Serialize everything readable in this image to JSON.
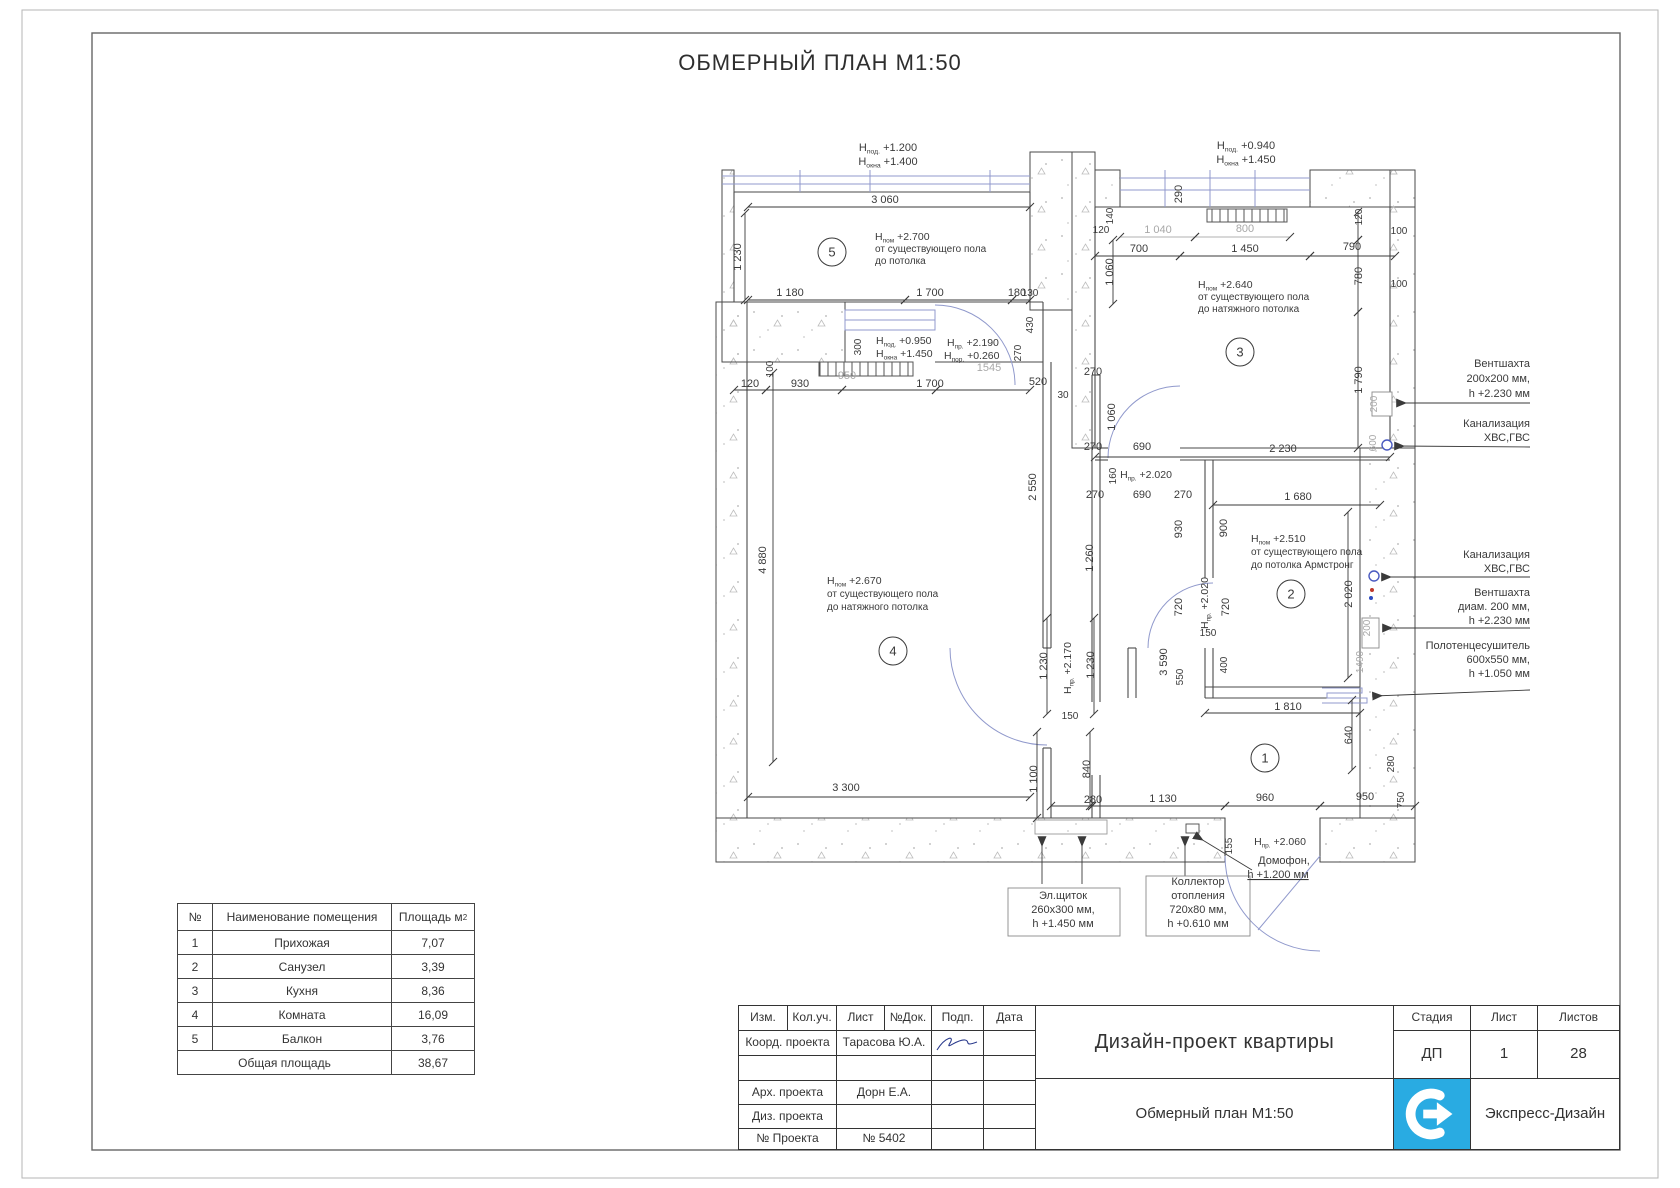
{
  "sheet": {
    "title": "ОБМЕРНЫЙ ПЛАН М1:50"
  },
  "colors": {
    "accent_blue": "#9099cc",
    "utility_blue": "#4a5ac0",
    "logo_blue": "#29abe2",
    "dim_gray": "#a8a8a8",
    "line": "#3a3a3a"
  },
  "plan": {
    "rooms": [
      {
        "n": "5",
        "x": 832,
        "y": 252
      },
      {
        "n": "3",
        "x": 1240,
        "y": 352
      },
      {
        "n": "2",
        "x": 1291,
        "y": 594
      },
      {
        "n": "4",
        "x": 893,
        "y": 651
      },
      {
        "n": "1",
        "x": 1265,
        "y": 758
      }
    ],
    "texts": [
      {
        "t": "Н|под.| +1.200",
        "x": 888,
        "y": 151
      },
      {
        "t": "Н|окна| +1.400",
        "x": 888,
        "y": 165
      },
      {
        "t": "3 060",
        "x": 885,
        "y": 203
      },
      {
        "t": "1 230",
        "x": 741,
        "y": 257,
        "r": -90
      },
      {
        "t": "Н|пом| +2.700",
        "x": 875,
        "y": 240,
        "a": "start",
        "fs": 10.5
      },
      {
        "t": "от существующего пола",
        "x": 875,
        "y": 252,
        "a": "start",
        "fs": 10
      },
      {
        "t": "до потолка",
        "x": 875,
        "y": 264,
        "a": "start",
        "fs": 10
      },
      {
        "t": "1 180",
        "x": 790,
        "y": 296
      },
      {
        "t": "1 700",
        "x": 930,
        "y": 296
      },
      {
        "t": "180",
        "x": 1017,
        "y": 296
      },
      {
        "t": "300",
        "x": 861,
        "y": 347,
        "r": -90,
        "fs": 10
      },
      {
        "t": "Н|под.| +0.950",
        "x": 876,
        "y": 344,
        "a": "start",
        "fs": 10.5
      },
      {
        "t": "Н|окна| +1.450",
        "x": 876,
        "y": 357,
        "a": "start",
        "fs": 10.5
      },
      {
        "t": "Н|пр.| +2.190",
        "x": 947,
        "y": 346,
        "a": "start",
        "fs": 10.5
      },
      {
        "t": "Н|пор.| +0.260",
        "x": 944,
        "y": 359,
        "a": "start",
        "fs": 10.5
      },
      {
        "t": "1545",
        "x": 989,
        "y": 371,
        "c": "g"
      },
      {
        "t": "100",
        "x": 773,
        "y": 369,
        "r": -90,
        "fs": 10
      },
      {
        "t": "120",
        "x": 750,
        "y": 387
      },
      {
        "t": "930",
        "x": 800,
        "y": 387
      },
      {
        "t": "950",
        "x": 847,
        "y": 379,
        "c": "g"
      },
      {
        "t": "1 700",
        "x": 930,
        "y": 387
      },
      {
        "t": "520",
        "x": 1038,
        "y": 385
      },
      {
        "t": "30",
        "x": 1063,
        "y": 398,
        "fs": 10
      },
      {
        "t": "4 880",
        "x": 766,
        "y": 560,
        "r": -90
      },
      {
        "t": "Н|пом| +2.670",
        "x": 827,
        "y": 584,
        "a": "start",
        "fs": 10.5
      },
      {
        "t": "от существующего пола",
        "x": 827,
        "y": 597,
        "a": "start",
        "fs": 10
      },
      {
        "t": "до натяжного потолка",
        "x": 827,
        "y": 610,
        "a": "start",
        "fs": 10
      },
      {
        "t": "2 550",
        "x": 1036,
        "y": 487,
        "r": -90
      },
      {
        "t": "1 260",
        "x": 1093,
        "y": 558,
        "r": -90
      },
      {
        "t": "1 230",
        "x": 1047,
        "y": 666,
        "r": -90
      },
      {
        "t": "Н|пр.| +2.170",
        "x": 1071,
        "y": 668,
        "r": -90,
        "fs": 10.5
      },
      {
        "t": "1 230",
        "x": 1094,
        "y": 665,
        "r": -90
      },
      {
        "t": "150",
        "x": 1070,
        "y": 719,
        "fs": 10
      },
      {
        "t": "3 300",
        "x": 846,
        "y": 791
      },
      {
        "t": "1 100",
        "x": 1037,
        "y": 779,
        "r": -90
      },
      {
        "t": "840",
        "x": 1090,
        "y": 769,
        "r": -90
      },
      {
        "t": "1 060",
        "x": 1113,
        "y": 272,
        "r": -90
      },
      {
        "t": "130",
        "x": 1030,
        "y": 296,
        "fs": 10
      },
      {
        "t": "430",
        "x": 1033,
        "y": 325,
        "r": -90,
        "fs": 10
      },
      {
        "t": "270",
        "x": 1021,
        "y": 353,
        "r": -90,
        "fs": 10
      },
      {
        "t": "270",
        "x": 1093,
        "y": 375
      },
      {
        "t": "1 060",
        "x": 1115,
        "y": 417,
        "r": -90
      },
      {
        "t": "270",
        "x": 1093,
        "y": 450
      },
      {
        "t": "690",
        "x": 1142,
        "y": 450
      },
      {
        "t": "Н|пр.| +2.020",
        "x": 1146,
        "y": 478,
        "fs": 10.5
      },
      {
        "t": "160",
        "x": 1116,
        "y": 476,
        "r": -90,
        "fs": 10
      },
      {
        "t": "270",
        "x": 1095,
        "y": 498
      },
      {
        "t": "690",
        "x": 1142,
        "y": 498
      },
      {
        "t": "270",
        "x": 1183,
        "y": 498
      },
      {
        "t": "930",
        "x": 1182,
        "y": 529,
        "r": -90
      },
      {
        "t": "900",
        "x": 1227,
        "y": 528,
        "r": -90
      },
      {
        "t": "Н|под.| +0.940",
        "x": 1246,
        "y": 149
      },
      {
        "t": "Н|окна| +1.450",
        "x": 1246,
        "y": 163
      },
      {
        "t": "290",
        "x": 1182,
        "y": 194,
        "r": -90
      },
      {
        "t": "140",
        "x": 1113,
        "y": 216,
        "r": -90,
        "fs": 10
      },
      {
        "t": "120",
        "x": 1101,
        "y": 233,
        "fs": 10
      },
      {
        "t": "1 040",
        "x": 1158,
        "y": 233,
        "c": "g"
      },
      {
        "t": "800",
        "x": 1245,
        "y": 232,
        "c": "g"
      },
      {
        "t": "700",
        "x": 1139,
        "y": 252
      },
      {
        "t": "1 450",
        "x": 1245,
        "y": 252
      },
      {
        "t": "790",
        "x": 1352,
        "y": 250
      },
      {
        "t": "120",
        "x": 1362,
        "y": 217,
        "r": -90,
        "fs": 10
      },
      {
        "t": "100",
        "x": 1399,
        "y": 234,
        "fs": 10
      },
      {
        "t": "780",
        "x": 1362,
        "y": 276,
        "r": -90
      },
      {
        "t": "100",
        "x": 1399,
        "y": 287,
        "fs": 10
      },
      {
        "t": "1 790",
        "x": 1362,
        "y": 380,
        "r": -90
      },
      {
        "t": "200",
        "x": 1377,
        "y": 404,
        "r": -90,
        "c": "g",
        "fs": 10
      },
      {
        "t": "600",
        "x": 1376,
        "y": 443,
        "r": -90,
        "c": "g",
        "fs": 10
      },
      {
        "t": "2 230",
        "x": 1283,
        "y": 452
      },
      {
        "t": "Н|пом| +2.640",
        "x": 1198,
        "y": 288,
        "a": "start",
        "fs": 10.5
      },
      {
        "t": "от существующего пола",
        "x": 1198,
        "y": 300,
        "a": "start",
        "fs": 10
      },
      {
        "t": "до натяжного потолка",
        "x": 1198,
        "y": 312,
        "a": "start",
        "fs": 10
      },
      {
        "t": "1 680",
        "x": 1298,
        "y": 500
      },
      {
        "t": "Н|пом| +2.510",
        "x": 1251,
        "y": 542,
        "a": "start",
        "fs": 10.5
      },
      {
        "t": "от существующего пола",
        "x": 1251,
        "y": 555,
        "a": "start",
        "fs": 10
      },
      {
        "t": "до потолка Армстронг",
        "x": 1251,
        "y": 568,
        "a": "start",
        "fs": 10
      },
      {
        "t": "720",
        "x": 1182,
        "y": 607,
        "r": -90
      },
      {
        "t": "Н|пр.| +2.020",
        "x": 1208,
        "y": 603,
        "r": -90,
        "fs": 10.5
      },
      {
        "t": "720",
        "x": 1229,
        "y": 607,
        "r": -90
      },
      {
        "t": "150",
        "x": 1208,
        "y": 636,
        "fs": 10
      },
      {
        "t": "2 020",
        "x": 1352,
        "y": 594,
        "r": -90
      },
      {
        "t": "200",
        "x": 1370,
        "y": 628,
        "r": -90,
        "c": "g",
        "fs": 10
      },
      {
        "t": "1490",
        "x": 1363,
        "y": 662,
        "r": -90,
        "c": "g",
        "fs": 10
      },
      {
        "t": "3 590",
        "x": 1167,
        "y": 662,
        "r": -90
      },
      {
        "t": "550",
        "x": 1183,
        "y": 677,
        "r": -90,
        "fs": 10
      },
      {
        "t": "400",
        "x": 1227,
        "y": 665,
        "r": -90,
        "fs": 10
      },
      {
        "t": "1 810",
        "x": 1288,
        "y": 710
      },
      {
        "t": "640",
        "x": 1352,
        "y": 735,
        "r": -90
      },
      {
        "t": "280",
        "x": 1394,
        "y": 764,
        "r": -90,
        "fs": 10
      },
      {
        "t": "750",
        "x": 1404,
        "y": 800,
        "r": -90,
        "fs": 10
      },
      {
        "t": "280",
        "x": 1093,
        "y": 803
      },
      {
        "t": "1 130",
        "x": 1163,
        "y": 802
      },
      {
        "t": "960",
        "x": 1265,
        "y": 801
      },
      {
        "t": "950",
        "x": 1365,
        "y": 800
      },
      {
        "t": "155",
        "x": 1232,
        "y": 846,
        "r": -90,
        "fs": 10
      },
      {
        "t": "Н|пр.| +2.060",
        "x": 1280,
        "y": 845,
        "fs": 10.5
      },
      {
        "t": "Домофон,",
        "x": 1284,
        "y": 864
      },
      {
        "t": "h +1.200 мм",
        "x": 1278,
        "y": 878,
        "u": true
      },
      {
        "t": "Эл.щиток",
        "x": 1063,
        "y": 899
      },
      {
        "t": "260х300 мм,",
        "x": 1063,
        "y": 913
      },
      {
        "t": "h +1.450 мм",
        "x": 1063,
        "y": 927
      },
      {
        "t": "Коллектор",
        "x": 1198,
        "y": 885
      },
      {
        "t": "отопления",
        "x": 1198,
        "y": 899
      },
      {
        "t": "720х80 мм,",
        "x": 1198,
        "y": 913
      },
      {
        "t": "h +0.610 мм",
        "x": 1198,
        "y": 927
      },
      {
        "t": "Вентшахта",
        "x": 1530,
        "y": 367,
        "a": "end"
      },
      {
        "t": "200х200 мм,",
        "x": 1530,
        "y": 382,
        "a": "end"
      },
      {
        "t": "h +2.230 мм",
        "x": 1530,
        "y": 397,
        "a": "end"
      },
      {
        "t": "Канализация",
        "x": 1530,
        "y": 427,
        "a": "end"
      },
      {
        "t": "ХВС,ГВС",
        "x": 1530,
        "y": 441,
        "a": "end"
      },
      {
        "t": "Канализация",
        "x": 1530,
        "y": 558,
        "a": "end"
      },
      {
        "t": "ХВС,ГВС",
        "x": 1530,
        "y": 572,
        "a": "end"
      },
      {
        "t": "Вентшахта",
        "x": 1530,
        "y": 596,
        "a": "end"
      },
      {
        "t": "диам. 200 мм,",
        "x": 1530,
        "y": 610,
        "a": "end"
      },
      {
        "t": "h +2.230 мм",
        "x": 1530,
        "y": 624,
        "a": "end"
      },
      {
        "t": "Полотенцесушитель",
        "x": 1530,
        "y": 649,
        "a": "end"
      },
      {
        "t": "600х550 мм,",
        "x": 1530,
        "y": 663,
        "a": "end"
      },
      {
        "t": "h +1.050 мм",
        "x": 1530,
        "y": 677,
        "a": "end"
      }
    ]
  },
  "legend_table": {
    "headers": [
      "№",
      "Наименование помещения",
      "Площадь м"
    ],
    "headers_area_sup": "2",
    "rows": [
      [
        "1",
        "Прихожая",
        "7,07"
      ],
      [
        "2",
        "Санузел",
        "3,39"
      ],
      [
        "3",
        "Кухня",
        "8,36"
      ],
      [
        "4",
        "Комната",
        "16,09"
      ],
      [
        "5",
        "Балкон",
        "3,76"
      ]
    ],
    "total_label": "Общая площадь",
    "total_value": "38,67"
  },
  "titleblock": {
    "cols": [
      "Изм.",
      "Кол.уч.",
      "Лист",
      "№Док.",
      "Подп.",
      "Дата"
    ],
    "rows": [
      {
        "label": "Коорд. проекта",
        "value": "Тарасова Ю.А."
      },
      {
        "label": "",
        "value": ""
      },
      {
        "label": "Арх. проекта",
        "value": "Дорн Е.А."
      },
      {
        "label": "Диз. проекта",
        "value": ""
      },
      {
        "label": "№ Проекта",
        "value": "№ 5402"
      }
    ],
    "project_title": "Дизайн-проект квартиры",
    "sheet_name": "Обмерный план М1:50",
    "stage_label": "Стадия",
    "stage_value": "ДП",
    "sheet_label": "Лист",
    "sheet_value": "1",
    "sheets_label": "Листов",
    "sheets_value": "28",
    "company": "Экспресс-Дизайн"
  }
}
